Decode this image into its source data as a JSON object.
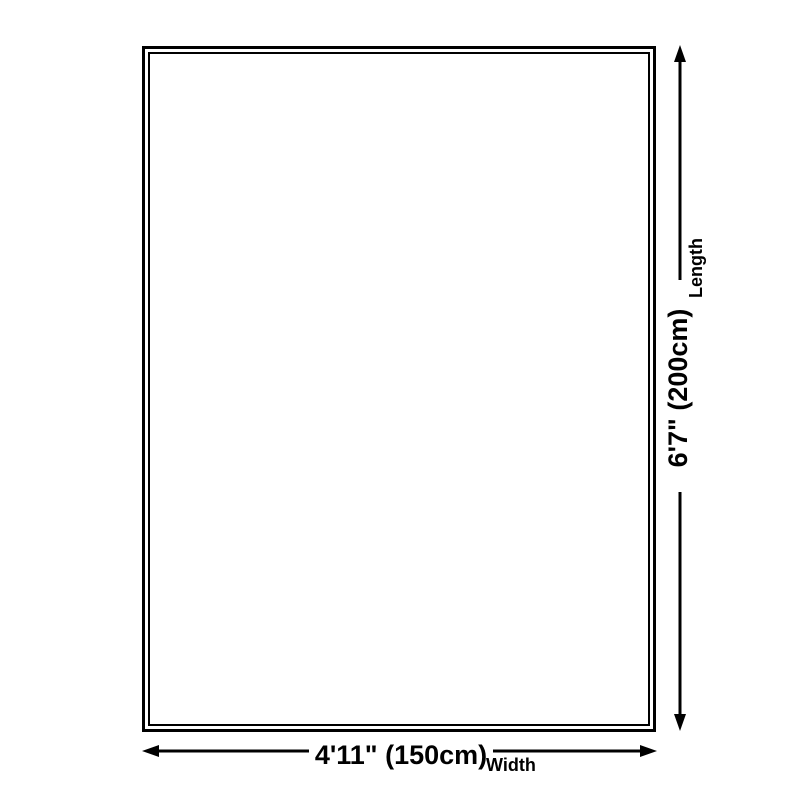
{
  "diagram": {
    "title": "rug-size-diagram",
    "rug": {
      "shape": "rectangle",
      "border_color": "#000000",
      "fill_color": "#ffffff"
    },
    "length_dimension": {
      "value_label": "6'7\" (200cm)",
      "unit_label": "Length",
      "orientation": "vertical"
    },
    "width_dimension": {
      "value_label": "4'11\" (150cm)",
      "unit_label": "Width",
      "orientation": "horizontal"
    },
    "colors": {
      "line": "#000000",
      "text": "#000000",
      "background": "#ffffff"
    }
  }
}
